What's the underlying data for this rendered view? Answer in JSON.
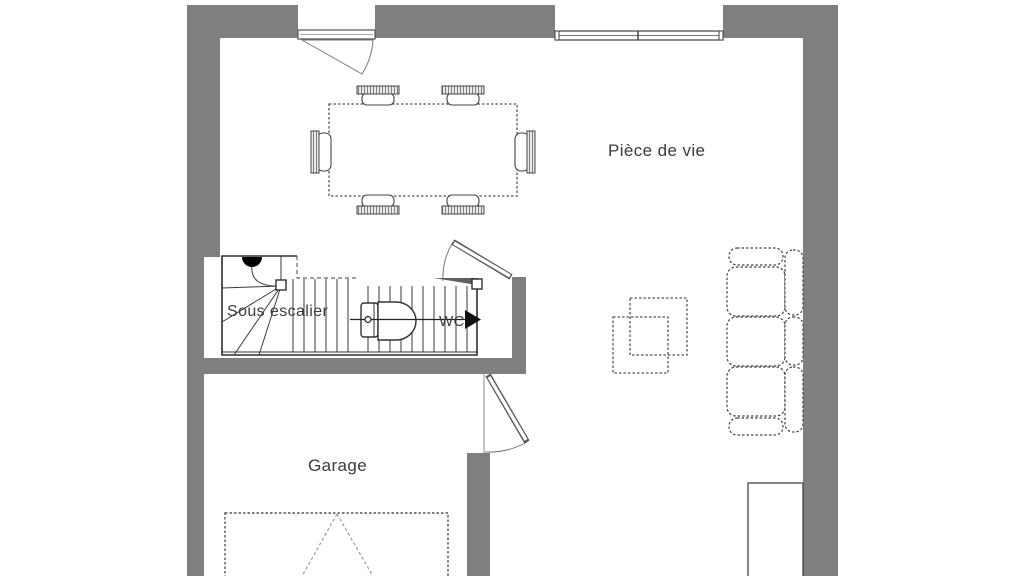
{
  "labels": {
    "living_room": "Pièce de vie",
    "under_stairs": "Sous escalier",
    "wc": "WC",
    "garage": "Garage"
  },
  "colors": {
    "wall": "#7f7f7f",
    "wall_dark": "#606060",
    "line": "#3f3f3f",
    "text": "#3c3c3c",
    "background": "#ffffff"
  },
  "legend": {
    "rooms": [
      "living-room",
      "under-stairs-storage",
      "wc",
      "garage"
    ],
    "doors": [
      "entry-door",
      "wc-door",
      "garage-interior-door"
    ],
    "windows": [
      "living-room-double-window"
    ],
    "furniture": [
      "dining-table",
      "dining-chair x6",
      "sofa",
      "coffee-table-squares",
      "toilet",
      "garage-car-space"
    ],
    "stairs": [
      "winder-staircase",
      "stair-direction-arrow"
    ]
  }
}
